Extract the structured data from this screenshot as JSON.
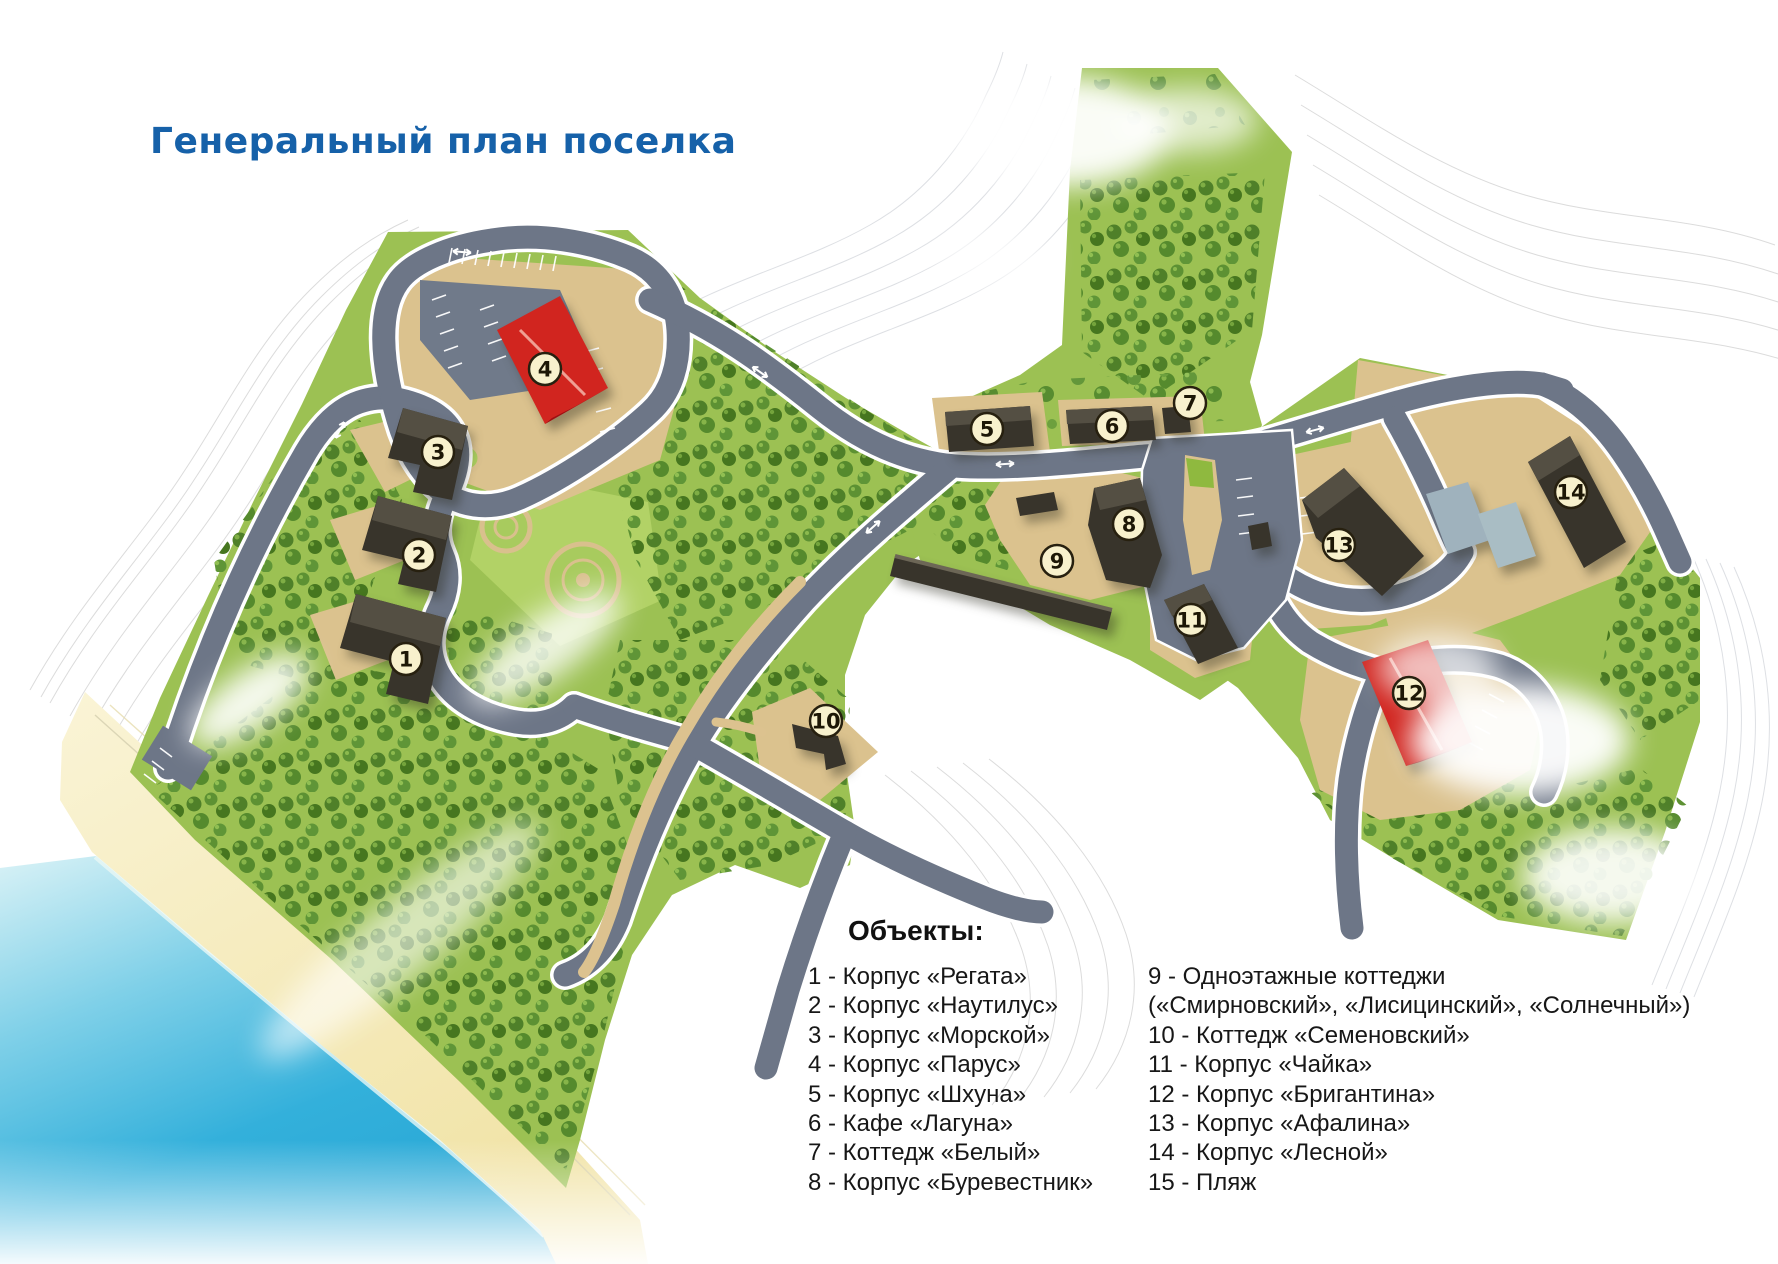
{
  "title": "Генеральный план поселка",
  "legend": {
    "header": "Объекты:",
    "columns": [
      {
        "lines": [
          "1 - Корпус «Регата»",
          "2 - Корпус «Наутилус»",
          "3 - Корпус «Морской»",
          "4 - Корпус «Парус»",
          "5 - Корпус «Шхуна»",
          "6 - Кафе «Лагуна»",
          "7 - Коттедж «Белый»",
          "8 - Корпус «Буревестник»"
        ]
      },
      {
        "lines": [
          "9 - Одноэтажные коттеджи",
          "(«Смирновский», «Лисицинский», «Солнечный»)",
          "10 - Коттедж «Семеновский»",
          "11 - Корпус «Чайка»",
          "12 - Корпус «Бригантина»",
          "13 - Корпус «Афалина»",
          "14 - Корпус «Лесной»",
          "15 - Пляж"
        ]
      }
    ]
  },
  "markers": [
    {
      "n": "1",
      "x": 406,
      "y": 659
    },
    {
      "n": "2",
      "x": 419,
      "y": 555
    },
    {
      "n": "3",
      "x": 438,
      "y": 452
    },
    {
      "n": "4",
      "x": 545,
      "y": 369
    },
    {
      "n": "5",
      "x": 987,
      "y": 429
    },
    {
      "n": "6",
      "x": 1112,
      "y": 426
    },
    {
      "n": "7",
      "x": 1190,
      "y": 403
    },
    {
      "n": "8",
      "x": 1129,
      "y": 524
    },
    {
      "n": "9",
      "x": 1057,
      "y": 561
    },
    {
      "n": "10",
      "x": 826,
      "y": 721
    },
    {
      "n": "11",
      "x": 1191,
      "y": 620
    },
    {
      "n": "12",
      "x": 1409,
      "y": 693
    },
    {
      "n": "13",
      "x": 1339,
      "y": 545
    },
    {
      "n": "14",
      "x": 1571,
      "y": 492
    }
  ],
  "colors": {
    "title_blue": "#1661a9",
    "land_green": "#9cc153",
    "forest_green": "#4f8029",
    "road_gray": "#6d7687",
    "plot_beige": "#dbc28e",
    "beach_sand": "#f6eebe",
    "sea_blue": "#2fadda",
    "building_dark": "#38342b",
    "building_red": "#d1251f",
    "marker_cream": "#f8f1cd"
  }
}
